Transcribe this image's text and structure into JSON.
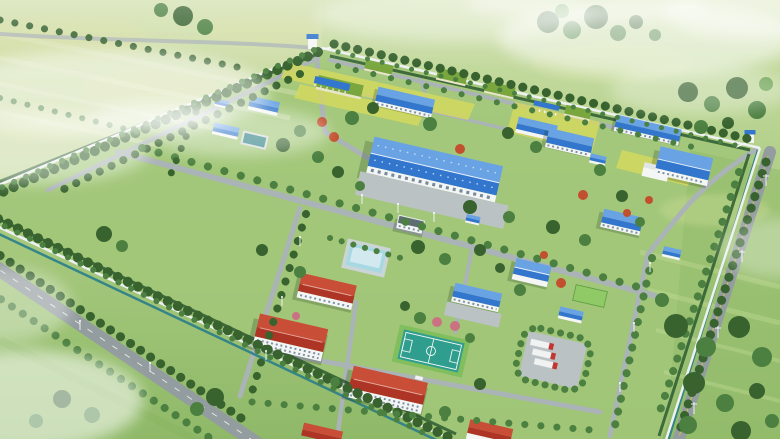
{
  "scene": {
    "kind": "aerial-3d-architectural-rendering",
    "subject": "Bird's-eye 3D rendering of a fenced rural industrial campus: blue-roofed production halls, workshops and sheds, red-roofed dormitory blocks, green earth-covered barns, tree-lined internal roads, a basketball court, water basins, a truck yard and two gatehouses, surrounded by misty green farmland with tree rows and country roads",
    "counts": {
      "blue_roof_buildings": 16,
      "red_roof_buildings": 5,
      "green_roof_sheds": 5,
      "grey_flat_roof_buildings": 1,
      "gatehouses": 2,
      "trucks": 3,
      "basketball_courts": 1,
      "water_basins": 2
    },
    "objects": [
      {
        "name": "main-warehouse",
        "label": "Large blue-roof production hall with front apron"
      },
      {
        "name": "north-gatehouse",
        "label": "North entrance gatehouse with barrier"
      },
      {
        "name": "east-gatehouse",
        "label": "East entrance gatehouse with barrier"
      },
      {
        "name": "dormitory-blocks",
        "label": "Red hip-roof two-storey dormitory/office blocks"
      },
      {
        "name": "green-sheds",
        "label": "Earth-sheltered green-roof barns in yellow-green plots"
      },
      {
        "name": "basketball-court",
        "label": "Teal outdoor basketball court with white markings"
      },
      {
        "name": "settling-basin",
        "label": "Pale-blue covered treatment basin"
      },
      {
        "name": "small-pool",
        "label": "Small dark-teal pool beside pump house"
      },
      {
        "name": "truck-yard",
        "label": "Parking yard with three red-cab trucks"
      },
      {
        "name": "perimeter",
        "label": "White perimeter wall with hedge, ditch and tree rows"
      },
      {
        "name": "outer-roads",
        "label": "Tree-lined country roads outside the wall"
      },
      {
        "name": "mist",
        "label": "Low fog patches drifting over the fields"
      }
    ]
  },
  "palette": {
    "fieldTop": "#cfe0ab",
    "fieldMid": "#abcc82",
    "fieldLow": "#8fb968",
    "compound": "#a2c779",
    "paleField": "#d6e0ae",
    "roofBlue": "#3276cd",
    "roofBlueLight": "#6aa3e4",
    "roofRed": "#ae3525",
    "roofRedLight": "#c94e38",
    "roofGreen": "#79a73e",
    "wallWhite": "#f4f6f5",
    "wallShade": "#ccd6d7",
    "roadGrey": "#aab3b5",
    "roadDark": "#939c9f",
    "edgeWhite": "#eef1f1",
    "laneYellow": "#d9c53e",
    "treeDark": "#38632f",
    "treeMid": "#4c8040",
    "treeLight": "#69a14e",
    "treeAutumn": "#c2502f",
    "treePink": "#cb7282",
    "hedge": "#2d5b31",
    "canal": "#2a7d8a",
    "courtTeal": "#2f9e8e",
    "pondBlue": "#a8d9e2",
    "poolTeal": "#2d8084",
    "apron": "#bac2c3",
    "truckRed": "#c23531",
    "truckWhite": "#f1f3f3",
    "yellowField": "#d6da5c"
  }
}
